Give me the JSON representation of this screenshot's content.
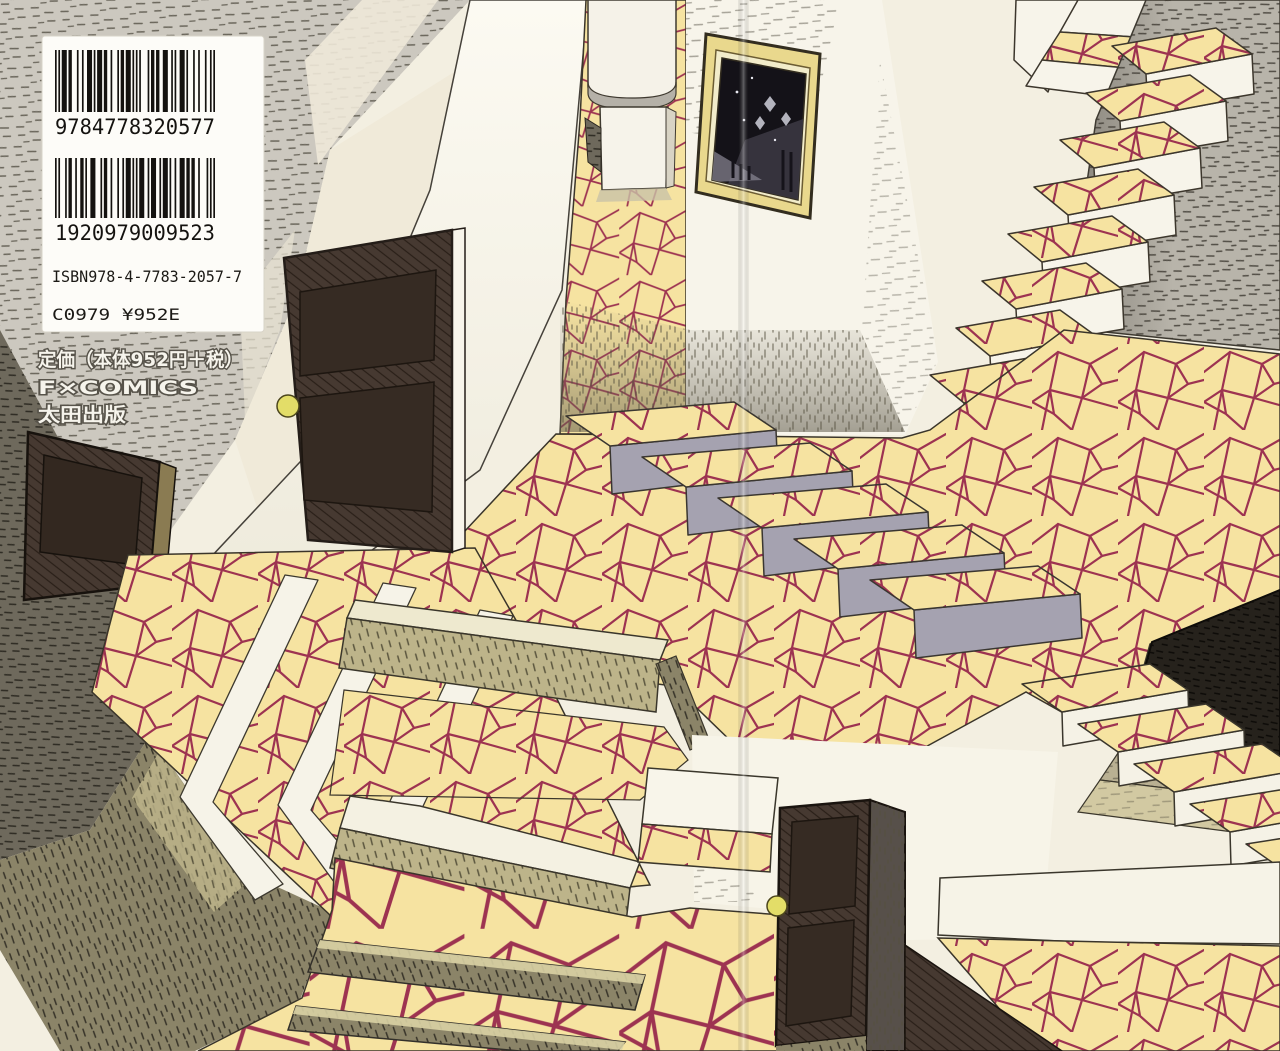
{
  "page": {
    "type": "book-back-cover",
    "width": 1280,
    "height": 1051
  },
  "barcode_panel": {
    "barcode1_digits": "9784778320577",
    "barcode2_digits": "1920979009523",
    "isbn_line": "ISBN978-4-7783-2057-7",
    "price_code_line": "C0979 ¥952E"
  },
  "imprint": {
    "price_line": "定価（本体952円＋税）",
    "label_line": "F×COMICS",
    "publisher_line": "太田出版"
  },
  "palette": {
    "paper": "#f3efe1",
    "wall_white": "#faf8ee",
    "tile_yellow": "#f6e3a1",
    "tile_line": "#9d3351",
    "foreground_yellow": "#f3d88b",
    "hatch_gray": "#ccc8bf",
    "olive": "#bdb48a",
    "dark_olive": "#8b8468",
    "door_brown": "#463931",
    "near_black": "#26221c",
    "frame_gold": "#e9d88d",
    "knob_yellow": "#e3dd68",
    "riser_gray": "#a5a2b0"
  }
}
